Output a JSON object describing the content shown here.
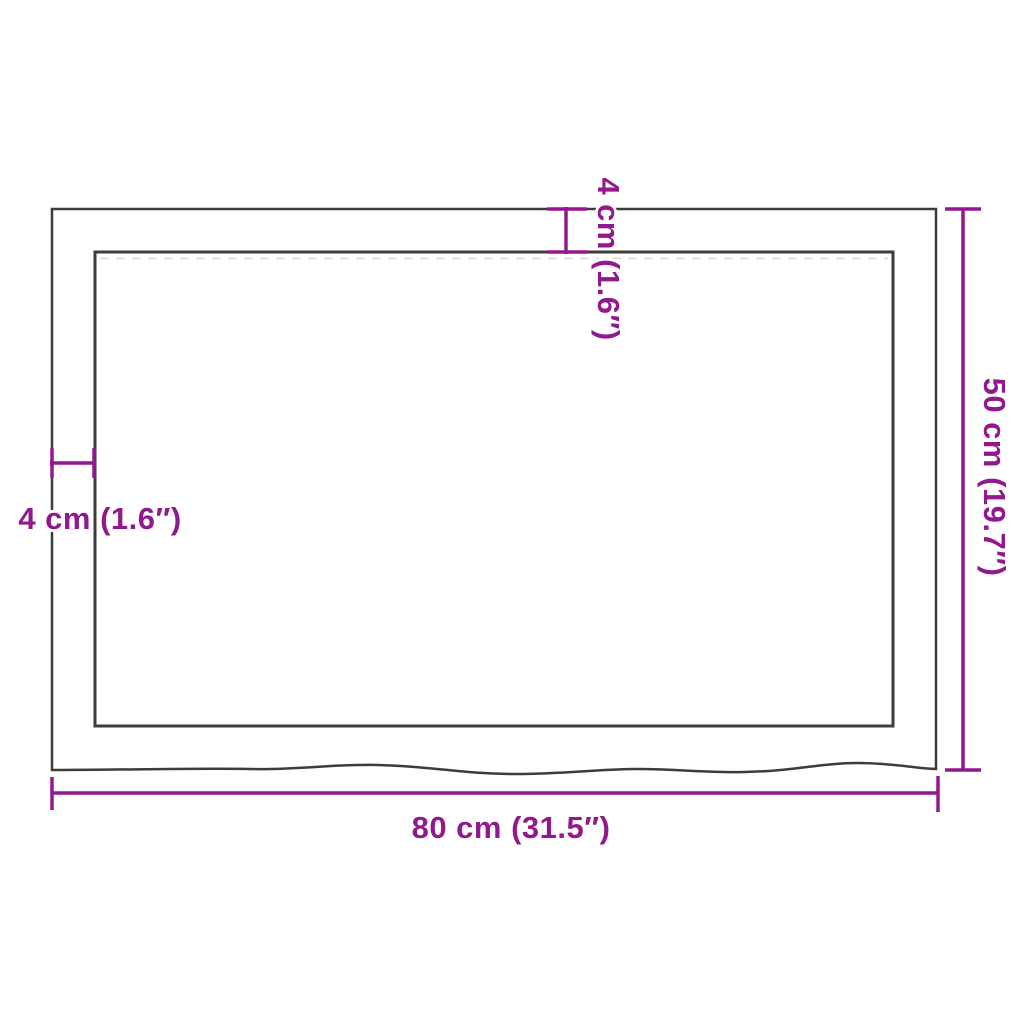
{
  "diagram": {
    "kind": "product-dimension-diagram",
    "subject": "rectangular wooden table top with live edge, top view",
    "labels": {
      "width": "80 cm (31.5″)",
      "height": "50 cm (19.7″)",
      "edge_thickness_top": "4 cm (1.6″)",
      "edge_thickness_left": "4 cm (1.6″)"
    },
    "values": {
      "width_cm": 80,
      "width_inch": 31.5,
      "height_cm": 50,
      "height_inch": 19.7,
      "edge_thickness_cm": 4,
      "edge_thickness_inch": 1.6
    },
    "colors": {
      "accent": "#92188E",
      "outline": "#3C3C3B",
      "background": "#FFFFFF"
    }
  }
}
